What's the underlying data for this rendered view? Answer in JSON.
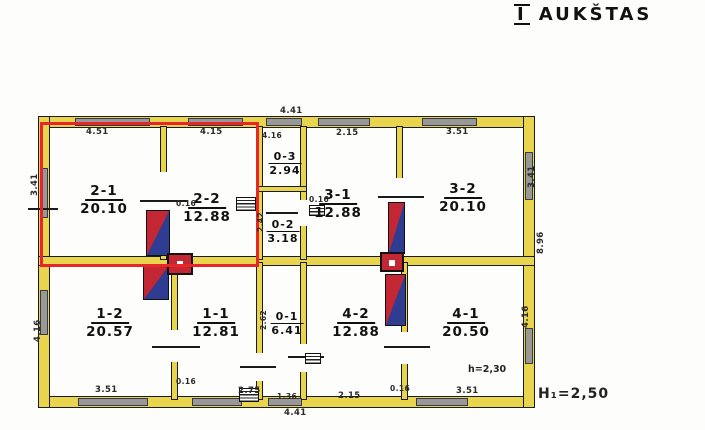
{
  "title": {
    "numeral": "I",
    "text": "AUKŠTAS"
  },
  "annotations": {
    "room_height": "h=2,30",
    "floor_height": "H₁=2,50"
  },
  "rooms": [
    {
      "id": "2-1",
      "area": "20.10"
    },
    {
      "id": "2-2",
      "area": "12.88"
    },
    {
      "id": "0-3",
      "area": "2.94"
    },
    {
      "id": "0-2",
      "area": "3.18"
    },
    {
      "id": "3-1",
      "area": "12.88"
    },
    {
      "id": "3-2",
      "area": "20.10"
    },
    {
      "id": "1-2",
      "area": "20.57"
    },
    {
      "id": "1-1",
      "area": "12.81"
    },
    {
      "id": "0-1",
      "area": "6.41"
    },
    {
      "id": "4-2",
      "area": "12.88"
    },
    {
      "id": "4-1",
      "area": "20.50"
    }
  ],
  "dimensions": [
    {
      "text": "4.51"
    },
    {
      "text": "4.15"
    },
    {
      "text": "4.41"
    },
    {
      "text": "4.16"
    },
    {
      "text": "2.15"
    },
    {
      "text": "3.51"
    },
    {
      "text": "3.41"
    },
    {
      "text": "3.41"
    },
    {
      "text": "8.96"
    },
    {
      "text": "4.16"
    },
    {
      "text": "4.16"
    },
    {
      "text": "3.51"
    },
    {
      "text": "0.16"
    },
    {
      "text": "2.75"
    },
    {
      "text": "1.36"
    },
    {
      "text": "4.41"
    },
    {
      "text": "2.15"
    },
    {
      "text": "3.51"
    },
    {
      "text": "0.16"
    },
    {
      "text": "2.42"
    },
    {
      "text": "2.62"
    },
    {
      "text": "0.16"
    },
    {
      "text": "0.16"
    }
  ],
  "colors": {
    "wall_yellow": "#e9d44e",
    "window_gray": "#989898",
    "highlight_red": "#e8262a",
    "stove_red": "#c22733",
    "stove_blue": "#2e3d92",
    "line_black": "#1b1b1b"
  }
}
